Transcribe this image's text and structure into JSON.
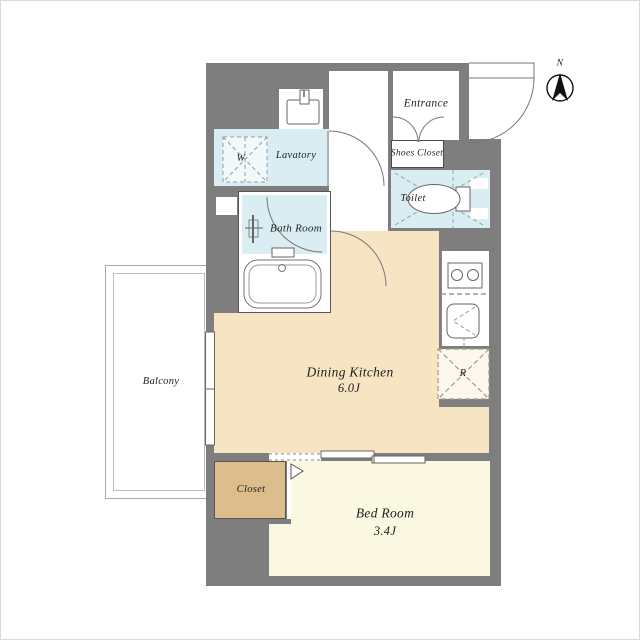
{
  "plan": {
    "rooms": {
      "entrance": {
        "label": "Entrance"
      },
      "shoes_closet": {
        "label": "Shoes Closet"
      },
      "toilet": {
        "label": "Toilet"
      },
      "lavatory": {
        "label": "Lavatory"
      },
      "washer_space": {
        "label": "W"
      },
      "bath": {
        "label": "Bath Room"
      },
      "dining_kitchen": {
        "label": "Dining Kitchen",
        "size": "6.0J"
      },
      "balcony": {
        "label": "Balcony"
      },
      "closet": {
        "label": "Closet"
      },
      "bedroom": {
        "label": "Bed Room",
        "size": "3.4J"
      },
      "refrigerator_space": {
        "label": "R"
      }
    },
    "compass": {
      "north": "N"
    }
  },
  "colors": {
    "wall": "#7e7e7e",
    "water": "#d9edf2",
    "kitchen_floor": "#f7e4c2",
    "bedroom_floor": "#fbf8e1",
    "closet_floor": "#dcbd8b",
    "line": "#6a6a6a",
    "dash": "#999999",
    "text": "#1f1f1f"
  }
}
